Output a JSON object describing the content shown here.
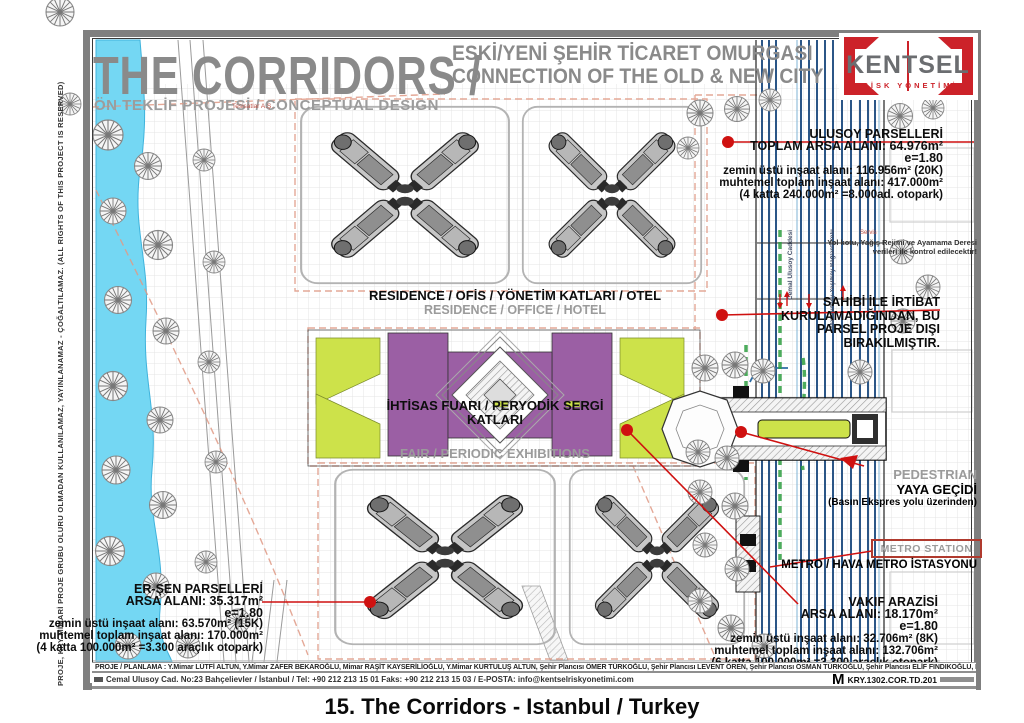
{
  "header": {
    "title": "THE CORRIDORS /",
    "subtitle": "ÖN TEKLİF PROJESİ / CONCEPTUAL DESIGN",
    "right_title_line1": "ESKİ/YENİ ŞEHİR TİCARET OMURGASI",
    "right_title_line2": "CONNECTION OF THE OLD & NEW CITY"
  },
  "logo": {
    "name": "KENTSEL",
    "tagline": "RİSK YÖNETİMİ"
  },
  "plan_labels": {
    "residence_tr": "RESIDENCE / OFİS / YÖNETİM KATLARI / OTEL",
    "residence_en": "RESIDENCE / OFFICE / HOTEL",
    "fair_line1": "İHTİSAS FUARI / PERYODİK SERGİ",
    "fair_line2": "KATLARI",
    "fair_en": "FAIR / PERIODIC EXHIBITIONS",
    "pedestrian_en": "PEDESTRIAN",
    "pedestrian_tr": "YAYA GEÇİDİ",
    "pedestrian_note": "(Basın Ekspres yolu üzerinden)",
    "metro_station_en": "METRO STATION",
    "metro_tr": "METRO / HAVA METRO İSTASYONU",
    "street_1": "Cemal Ulusoy Caddesi",
    "street_2": "Mahmutbey-Yeşilköy Bağlantı Yolu",
    "tiny_1": "Tesisatlar A.Ş.",
    "tiny_2": "Servis"
  },
  "notes": {
    "sahibi": {
      "lines": [
        "SAHİBİ İLE İRTİBAT",
        "KURULAMADIĞINDAN, BU",
        "PARSEL PROJE DIŞI",
        "BIRAKILMIŞTIR."
      ]
    },
    "road_note": {
      "lines": [
        "Yol kotu, Yağış Rejimi ve Ayamama Deresi",
        "verileri ile kontrol edilecektir!"
      ]
    }
  },
  "parcels": {
    "ulusoy": {
      "lines": [
        "ULUSOY PARSELLERİ",
        "TOPLAM ARSA ALANI: 64.976m²",
        "e=1.80",
        "zemin üstü inşaat alanı: 116.956m² (20K)",
        "muhtemel toplam inşaat alanı: 417.000m²",
        "(4 katta 240.000m² =8.000ad. otopark)"
      ]
    },
    "ersen": {
      "lines": [
        "ER-ŞEN PARSELLERİ",
        "ARSA ALANI: 35.317m²",
        "e=1.80",
        "zemin üstü inşaat alanı: 63.570m² (15K)",
        "muhtemel toplam inşaat alanı: 170.000m²",
        "(4 katta 100.000m² =3.300 araçlık otopark)"
      ]
    },
    "vakif": {
      "lines": [
        "VAKIF ARAZİSİ",
        "ARSA ALANI: 18.170m²",
        "e=1.80",
        "zemin üstü inşaat alanı: 32.706m² (8K)",
        "muhtemel toplam inşaat alanı: 132.706m²",
        "(6 katta 100.000m² =3.300 araçlık otopark)"
      ]
    }
  },
  "footer": {
    "credits": "PROJE / PLANLAMA : Y.Mimar LÜTFİ ALTUN, Y.Mimar ZAFER BEKAROĞLU, Mimar RAŞİT KAYSERİLİOĞLU, Y.Mimar KURTULUŞ ALTUN, Şehir Plancısı ÖMER TÜRKOĞLU, Şehir Plancısı LEVENT ÖREN, Şehir Plancısı OSMAN TÜRKOĞLU, Şehir Plancısı ELİF FINDIKOĞLU, Mimar ŞEVKİ ÇATLADI",
    "address": "Cemal Ulusoy Cad. No:23 Bahçelievler / İstanbul  /  Tel: +90 212 213 15 01 Faks: +90 212 213 15 03  /  E-POSTA: info@kentselriskyonetimi.com",
    "logo_letter": "M",
    "doc_code": "KRY.1302.COR.TD.201"
  },
  "caption": "15. The Corridors - Istanbul / Turkey",
  "copyright_vertical": "PROJE, KRY MİMARİ PROJE GRUBU OLURU OLMADAN KULLANILAMAZ, YAYINLANAMAZ - ÇOĞALTILAMAZ. (ALL RIGHTS OF THIS PROJECT IS RESERVED)",
  "colors": {
    "leader_red": "#cf1110",
    "lime": "#cde24a",
    "purple": "#9b5fa4",
    "river_blue": "#74d7f3",
    "road_navy": "#2b5687",
    "landscape_green": "#2f9e41",
    "parcel_salmon": "#e09a85",
    "title_gray": "#8a8a8a",
    "logo_red": "#cc2229"
  }
}
